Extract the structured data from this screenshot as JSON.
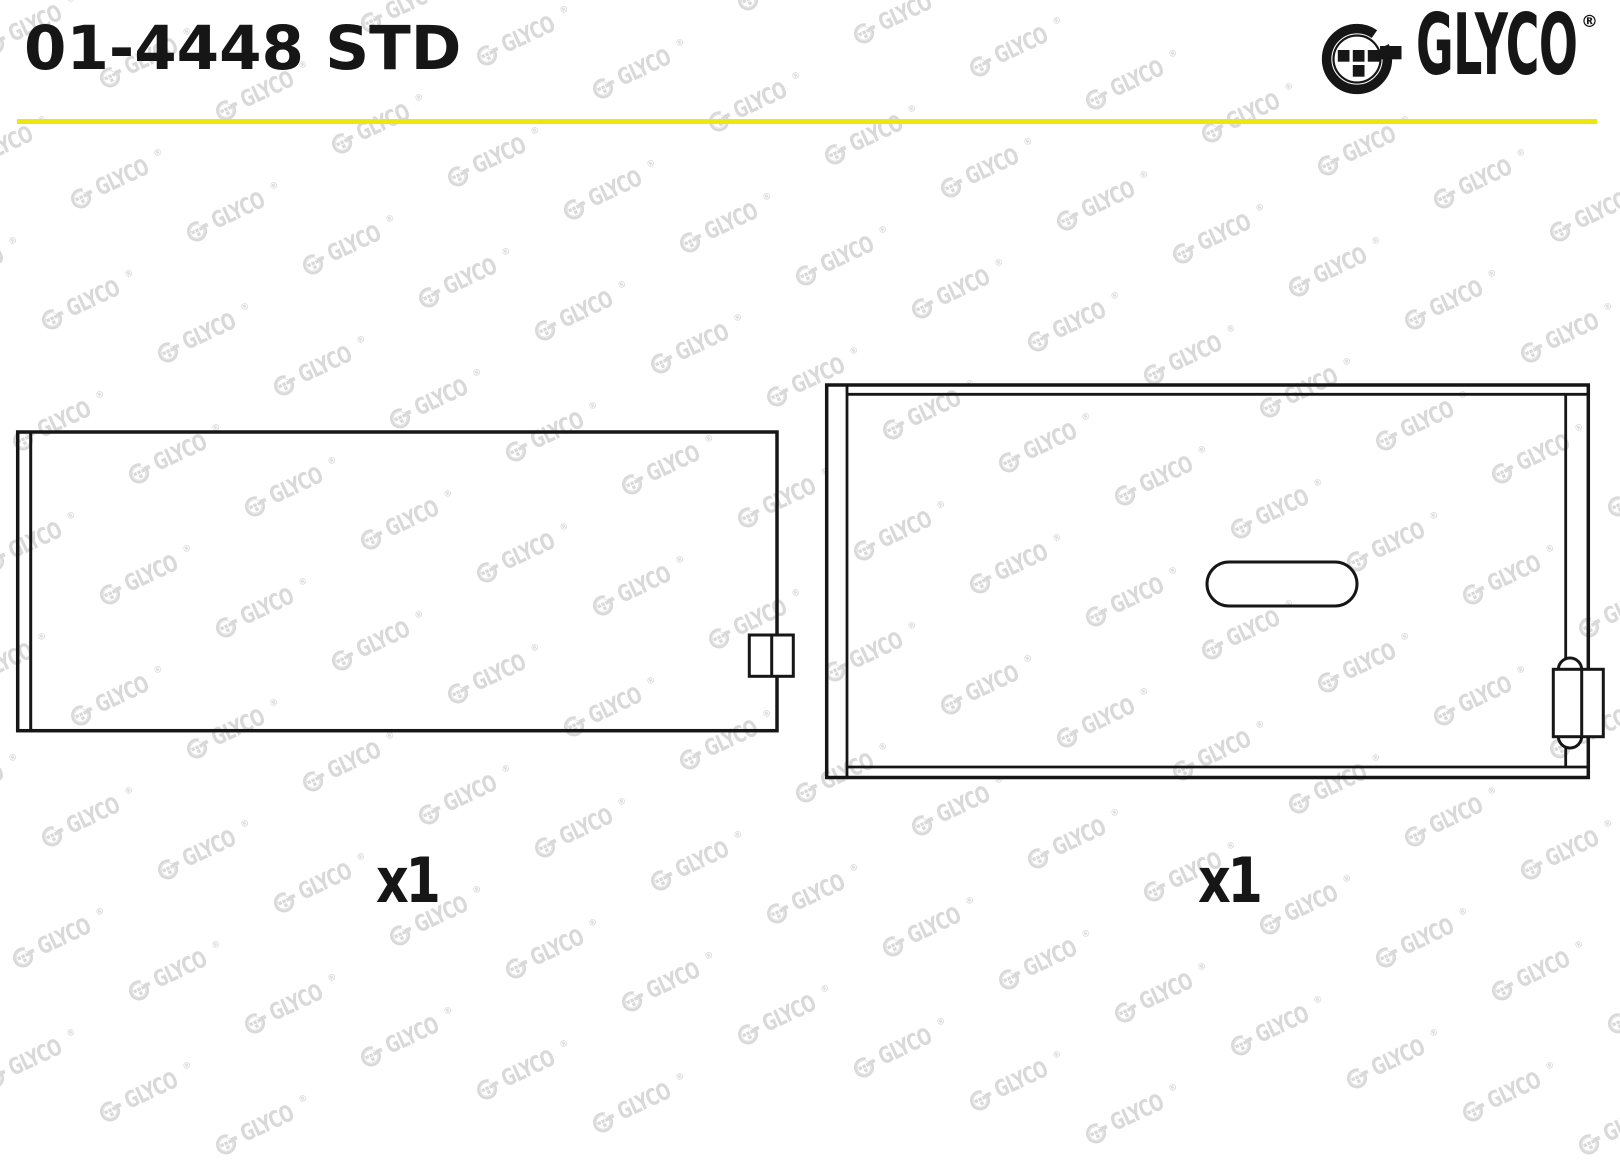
{
  "header": {
    "part_number": "01-4448 STD"
  },
  "brand": {
    "name": "GLYCO",
    "registered": "®"
  },
  "figures": [
    {
      "id": "upper-shell-side-view",
      "quantity_label": "x1"
    },
    {
      "id": "lower-shell-back-view",
      "quantity_label": "x1"
    }
  ],
  "watermark": {
    "text": "GLYCO",
    "registered": "®"
  },
  "colors": {
    "ink": "#161616",
    "accent_yellow": "#ece80d",
    "watermark_gray": "#d9d9d9",
    "background": "#ffffff"
  }
}
